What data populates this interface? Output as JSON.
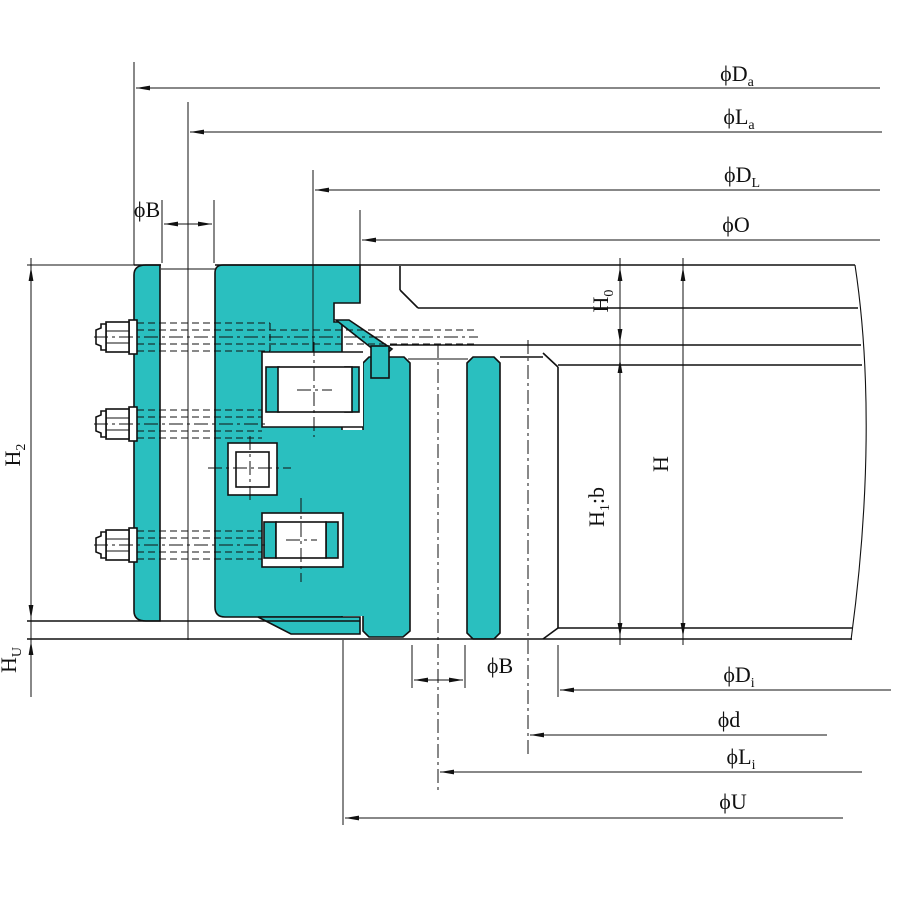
{
  "drawing": {
    "type": "slewing-bearing-cross-section",
    "colors": {
      "part_fill": "#2ABFBF",
      "line_color": "#111111",
      "background": "#FFFFFF"
    },
    "dims": {
      "da": {
        "base": "ϕD",
        "sub": "a",
        "rest": ""
      },
      "la": {
        "base": "ϕL",
        "sub": "a",
        "rest": ""
      },
      "dl": {
        "base": "ϕD",
        "sub": "L",
        "rest": ""
      },
      "o": {
        "base": "ϕO",
        "sub": "",
        "rest": ""
      },
      "b_top": {
        "base": "ϕB",
        "sub": "",
        "rest": ""
      },
      "b_bottom": {
        "base": "ϕB",
        "sub": "",
        "rest": ""
      },
      "di": {
        "base": "ϕD",
        "sub": "i",
        "rest": ""
      },
      "d": {
        "base": "ϕd",
        "sub": "",
        "rest": ""
      },
      "li": {
        "base": "ϕL",
        "sub": "i",
        "rest": ""
      },
      "u": {
        "base": "ϕU",
        "sub": "",
        "rest": ""
      },
      "h2": {
        "base": "H",
        "sub": "2",
        "rest": ""
      },
      "hu": {
        "base": "H",
        "sub": "U",
        "rest": ""
      },
      "h0": {
        "base": "H",
        "sub": "0",
        "rest": ""
      },
      "h1b": {
        "base": "H",
        "sub": "1",
        "rest": ":b"
      },
      "h": {
        "base": "H",
        "sub": "",
        "rest": ""
      }
    }
  }
}
